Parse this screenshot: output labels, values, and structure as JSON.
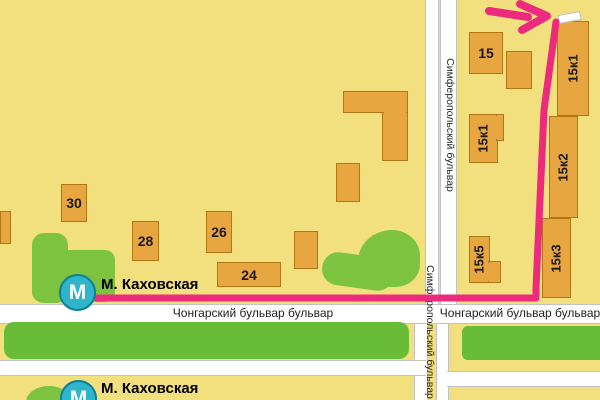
{
  "stations": [
    {
      "symbol": "М",
      "label": "М. Каховская"
    },
    {
      "symbol": "М",
      "label": "М. Каховская"
    }
  ],
  "streets": {
    "chongarsky_left": "Чонгарский бульвар бульвар",
    "chongarsky_right": "Чонгарский бульвар бульвар",
    "simferopolsky_upper": "Симферопольский бульвар",
    "simferopolsky_lower": "Симферопольский бульвар"
  },
  "buildings": [
    {
      "label": "30",
      "x": 61,
      "y": 184,
      "w": 26,
      "h": 38,
      "vertical": false
    },
    {
      "label": "28",
      "x": 132,
      "y": 221,
      "w": 27,
      "h": 40,
      "vertical": false
    },
    {
      "label": "26",
      "x": 206,
      "y": 211,
      "w": 26,
      "h": 42,
      "vertical": false
    },
    {
      "label": "24",
      "x": 217,
      "y": 262,
      "w": 64,
      "h": 25,
      "vertical": false
    },
    {
      "label": "",
      "x": 294,
      "y": 231,
      "w": 24,
      "h": 38,
      "vertical": false
    },
    {
      "label": "",
      "x": 0,
      "y": 211,
      "w": 11,
      "h": 33,
      "vertical": false
    },
    {
      "label": "",
      "x": 336,
      "y": 163,
      "w": 24,
      "h": 39,
      "vertical": false
    },
    {
      "label": "",
      "x": 343,
      "y": 91,
      "w": 65,
      "h": 22,
      "vertical": false
    },
    {
      "label": "",
      "x": 382,
      "y": 112,
      "w": 26,
      "h": 49,
      "vertical": false
    },
    {
      "label": "",
      "x": 384,
      "y": 110,
      "w": 22,
      "h": 4,
      "vertical": false,
      "patch": true
    },
    {
      "label": "15",
      "x": 469,
      "y": 32,
      "w": 34,
      "h": 42,
      "vertical": false
    },
    {
      "label": "",
      "x": 506,
      "y": 51,
      "w": 26,
      "h": 38,
      "vertical": false
    },
    {
      "label": "15к1",
      "x": 469,
      "y": 114,
      "w": 29,
      "h": 49,
      "vertical": true
    },
    {
      "label": "",
      "x": 496,
      "y": 114,
      "w": 8,
      "h": 27,
      "vertical": false
    },
    {
      "label": "",
      "x": 494,
      "y": 116,
      "w": 4,
      "h": 23,
      "vertical": false,
      "patch": true
    },
    {
      "label": "15к5",
      "x": 469,
      "y": 236,
      "w": 21,
      "h": 47,
      "vertical": true
    },
    {
      "label": "",
      "x": 488,
      "y": 261,
      "w": 13,
      "h": 22,
      "vertical": false
    },
    {
      "label": "",
      "x": 487,
      "y": 263,
      "w": 4,
      "h": 18,
      "vertical": false,
      "patch": true
    },
    {
      "label": "15к1",
      "x": 557,
      "y": 21,
      "w": 32,
      "h": 95,
      "vertical": true
    },
    {
      "label": "15к2",
      "x": 549,
      "y": 116,
      "w": 29,
      "h": 102,
      "vertical": true
    },
    {
      "label": "15к3",
      "x": 542,
      "y": 218,
      "w": 29,
      "h": 80,
      "vertical": true
    }
  ],
  "colors": {
    "background": "#F2DF7E",
    "building_fill": "#E8A640",
    "building_border": "#B27715",
    "park_green": "#7CC340",
    "median_green": "#68BC38",
    "road_white": "#FFFFFF",
    "route_pink": "#ED2B7C",
    "metro_teal": "#2EB5C9",
    "metro_border": "#0E7F99"
  }
}
